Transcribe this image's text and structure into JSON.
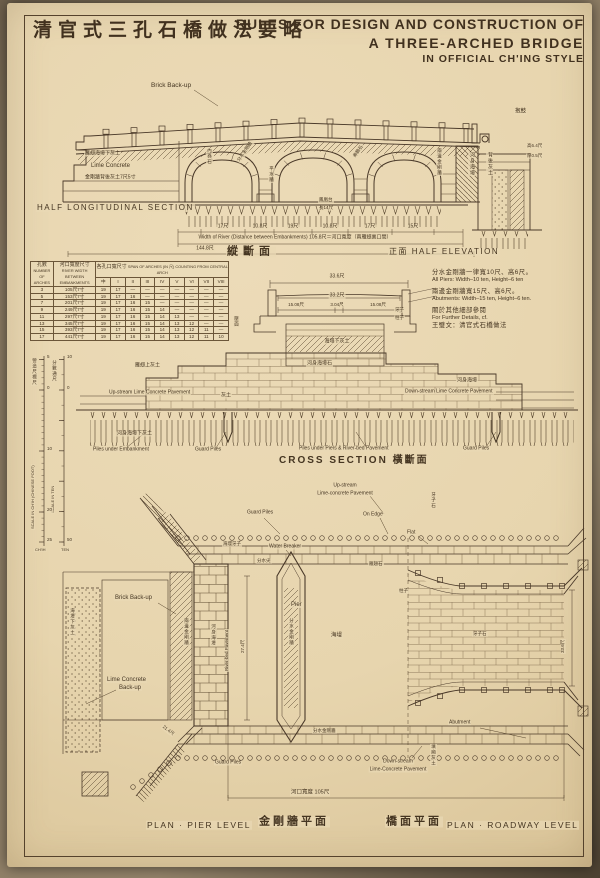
{
  "title": {
    "zh": "清官式三孔石橋做法要略",
    "en1": "RULES FOR DESIGN AND CONSTRUCTION OF",
    "en2": "A THREE-ARCHED BRIDGE",
    "en3": "IN OFFICIAL CH'ING STYLE"
  },
  "colors": {
    "paper": "#e8d6b0",
    "ink": "#4a3929",
    "faint_ink": "#7a6448"
  },
  "notes": {
    "lines": [
      {
        "t": "分水金剛牆一律寬10尺、高6尺。",
        "zh": true
      },
      {
        "t": "All Piers: Width–10 ten, Height–6 ten",
        "zh": false
      },
      {
        "t": "兩邊金剛牆寬15尺、高6尺。",
        "zh": true,
        "gap": true
      },
      {
        "t": "Abutments: Width–15 ten, Height–6 ten.",
        "zh": false
      },
      {
        "t": "關於其他細部參閱",
        "zh": true,
        "gap": true
      },
      {
        "t": "For Further Details, cf.",
        "zh": false
      },
      {
        "t": "王璧文：清官式石橋做法",
        "zh": true
      }
    ]
  },
  "table": {
    "h_arches_zh": "孔數",
    "h_arches_en": "NUMBER OF ARCHES",
    "h_width_zh": "河口寬度尺寸",
    "h_width_en": "RIVER WIDTH BETWEEN EMBANKMENTS",
    "h_span_zh": "各孔口寬尺寸",
    "h_span_en": "SPAN OF ARCHES (IN 尺) COUNTING FROM CENTRAL ARCH",
    "span_cols": [
      "中",
      "I",
      "II",
      "III",
      "IV",
      "V",
      "VI",
      "VII",
      "VIII"
    ],
    "rows": [
      {
        "arches": "3",
        "river_width": "105尺7寸",
        "spans": [
          "19",
          "17",
          "—",
          "—",
          "—",
          "—",
          "—",
          "—",
          "—"
        ]
      },
      {
        "arches": "5",
        "river_width": "153尺7寸",
        "spans": [
          "19",
          "17",
          "16",
          "—",
          "—",
          "—",
          "—",
          "—",
          "—"
        ]
      },
      {
        "arches": "7",
        "river_width": "201尺7寸",
        "spans": [
          "19",
          "17",
          "16",
          "15",
          "—",
          "—",
          "—",
          "—",
          "—"
        ]
      },
      {
        "arches": "9",
        "river_width": "249尺7寸",
        "spans": [
          "19",
          "17",
          "16",
          "15",
          "14",
          "—",
          "—",
          "—",
          "—"
        ]
      },
      {
        "arches": "11",
        "river_width": "297尺7寸",
        "spans": [
          "19",
          "17",
          "16",
          "15",
          "14",
          "13",
          "—",
          "—",
          "—"
        ]
      },
      {
        "arches": "13",
        "river_width": "345尺7寸",
        "spans": [
          "19",
          "17",
          "16",
          "15",
          "14",
          "13",
          "12",
          "—",
          "—"
        ]
      },
      {
        "arches": "15",
        "river_width": "393尺7寸",
        "spans": [
          "19",
          "17",
          "16",
          "15",
          "14",
          "13",
          "12",
          "11",
          "—"
        ]
      },
      {
        "arches": "17",
        "river_width": "441尺7寸",
        "spans": [
          "19",
          "17",
          "16",
          "15",
          "14",
          "13",
          "12",
          "11",
          "10"
        ]
      }
    ]
  },
  "annotations": [
    {
      "n": "label-brick-backup-section",
      "t": "Brick Back-up",
      "x": 150,
      "y": 86,
      "s": 6.5
    },
    {
      "n": "caption-half-longitudinal-section",
      "t": "HALF LONGITUDINAL SECTION",
      "x": 36,
      "y": 208,
      "s": 8,
      "ls": 1.5
    },
    {
      "n": "caption-longitudinal-zh",
      "t": "縱斷面",
      "x": 226,
      "y": 252,
      "s": 11,
      "b": 1,
      "ls": 5
    },
    {
      "n": "caption-half-elevation",
      "t": "正面  HALF ELEVATION",
      "x": 388,
      "y": 252,
      "s": 8,
      "ls": 1.5
    },
    {
      "n": "label-lime-concrete-section",
      "t": "Lime Concrete",
      "x": 90,
      "y": 166,
      "s": 6
    },
    {
      "n": "label-lime-backing-zh",
      "t": "金剛牆背後灰土7尺5寸",
      "x": 84,
      "y": 178,
      "s": 5
    },
    {
      "n": "label-wing-pavement-zh",
      "t": "雁翅海墁下灰土",
      "x": 84,
      "y": 154,
      "s": 5
    },
    {
      "n": "label-baogu",
      "t": "抱鼓",
      "x": 514,
      "y": 112,
      "s": 5.5
    },
    {
      "n": "label-riverbed-pav-v1",
      "t": "河身海墁",
      "x": 468,
      "y": 152,
      "v": 1,
      "s": 5
    },
    {
      "n": "label-backfill-v1",
      "t": "背後灰土",
      "x": 486,
      "y": 152,
      "v": 1,
      "s": 5
    },
    {
      "n": "label-height-dim",
      "t": "高6.4尺",
      "x": 526,
      "y": 146,
      "s": 4.5
    },
    {
      "n": "label-thick-dim",
      "t": "厚0.5尺",
      "x": 526,
      "y": 156,
      "s": 4.5
    },
    {
      "n": "label-arch-ring-v",
      "t": "內券石",
      "x": 206,
      "y": 148,
      "v": 1,
      "s": 4.5
    },
    {
      "n": "label-pier-wall-diag",
      "t": "分水金剛牆",
      "x": 238,
      "y": 162,
      "r": -55,
      "s": 4.5
    },
    {
      "n": "label-archface-diag",
      "t": "券臉石",
      "x": 354,
      "y": 158,
      "r": -55,
      "s": 4.5
    },
    {
      "n": "label-side-wall-v1",
      "t": "兩邊金剛牆",
      "x": 436,
      "y": 148,
      "v": 1,
      "s": 4.5
    },
    {
      "n": "label-pingshui-v",
      "t": "平水牆",
      "x": 268,
      "y": 166,
      "v": 1,
      "s": 4.5
    },
    {
      "n": "label-fenghuangtai",
      "t": "鳳凰台",
      "x": 318,
      "y": 200,
      "s": 4.5
    },
    {
      "n": "label-length-dim",
      "t": "長14尺",
      "x": 318,
      "y": 208,
      "s": 4.5
    },
    {
      "n": "dim-17a",
      "t": "17尺",
      "x": 223,
      "y": 227,
      "a": "c",
      "s": 5
    },
    {
      "n": "dim-108a",
      "t": "10.8尺",
      "x": 260,
      "y": 227,
      "a": "c",
      "s": 5
    },
    {
      "n": "dim-19",
      "t": "19尺",
      "x": 293,
      "y": 227,
      "a": "c",
      "s": 5
    },
    {
      "n": "dim-108b",
      "t": "10.8尺",
      "x": 330,
      "y": 227,
      "a": "c",
      "s": 5
    },
    {
      "n": "dim-17b",
      "t": "17尺",
      "x": 370,
      "y": 227,
      "a": "c",
      "s": 5
    },
    {
      "n": "dim-15",
      "t": "15尺",
      "x": 413,
      "y": 227,
      "a": "c",
      "s": 5
    },
    {
      "n": "dim-river-width",
      "t": "Width of River (Distance between Embankments) 105.8尺＝河口寬度（兩雁翅裏口間）",
      "x": 295,
      "y": 238,
      "a": "c",
      "s": 5
    },
    {
      "n": "dim-total-width",
      "t": "144.8尺",
      "x": 205,
      "y": 249,
      "a": "c",
      "s": 5
    },
    {
      "n": "dim-336-top",
      "t": "33.6尺",
      "x": 337,
      "y": 277,
      "a": "c",
      "s": 5
    },
    {
      "n": "dim-332",
      "t": "33.2尺",
      "x": 337,
      "y": 296,
      "a": "c",
      "s": 5
    },
    {
      "n": "dim-1508a",
      "t": "15.08尺",
      "x": 296,
      "y": 305,
      "a": "c",
      "s": 4.5
    },
    {
      "n": "dim-304",
      "t": "3.04尺",
      "x": 337,
      "y": 305,
      "a": "c",
      "s": 4.5
    },
    {
      "n": "dim-1508b",
      "t": "15.08尺",
      "x": 378,
      "y": 305,
      "a": "c",
      "s": 4.5
    },
    {
      "n": "label-deck-lime",
      "t": "海墁下灰土",
      "x": 337,
      "y": 342,
      "a": "c",
      "s": 5
    },
    {
      "n": "label-yazi-sec",
      "t": "牙子",
      "x": 394,
      "y": 310,
      "s": 4.5
    },
    {
      "n": "label-zhuzi-sec",
      "t": "柱子",
      "x": 394,
      "y": 318,
      "s": 4.5
    },
    {
      "n": "label-yamian-v",
      "t": "壓面",
      "x": 233,
      "y": 316,
      "v": 1,
      "s": 4.5
    },
    {
      "n": "label-riverbed-stone",
      "t": "河身海墁石",
      "x": 306,
      "y": 364,
      "s": 5
    },
    {
      "n": "label-wing-lime",
      "t": "雁翅上灰土",
      "x": 134,
      "y": 366,
      "s": 5
    },
    {
      "n": "label-upstream-pavement-cs",
      "t": "Up-stream Lime Concrete Pavement",
      "x": 108,
      "y": 393,
      "s": 5
    },
    {
      "n": "label-huitu",
      "t": "灰土",
      "x": 220,
      "y": 396,
      "s": 5
    },
    {
      "n": "label-riverbed-pav2",
      "t": "河身海墁",
      "x": 456,
      "y": 381,
      "s": 5
    },
    {
      "n": "label-downstream-pavement-cs",
      "t": "Down-stream Lime Concrete Pavement",
      "x": 404,
      "y": 392,
      "s": 5
    },
    {
      "n": "label-riverbed-lime",
      "t": "河身海墁下灰土",
      "x": 116,
      "y": 434,
      "s": 5
    },
    {
      "n": "label-piles-embankment",
      "t": "Piles under Embankment",
      "x": 92,
      "y": 450,
      "s": 5
    },
    {
      "n": "label-guard-piles-cross-left",
      "t": "Guard Piles",
      "x": 194,
      "y": 450,
      "s": 5
    },
    {
      "n": "label-piles-piers",
      "t": "Piles under Piers & River-bed Pavement",
      "x": 298,
      "y": 449,
      "s": 5
    },
    {
      "n": "label-guard-piles-cross-right",
      "t": "Guard Piles",
      "x": 462,
      "y": 449,
      "s": 5
    },
    {
      "n": "caption-cross-section",
      "t": "CROSS SECTION  橫斷面",
      "x": 278,
      "y": 461,
      "s": 10,
      "ls": 2,
      "b": 1
    },
    {
      "n": "ruler-zh-left",
      "t": "營造尺標尺",
      "x": 31,
      "y": 358,
      "v": 1,
      "s": 4.5
    },
    {
      "n": "ruler-zh-right",
      "t": "分數通尺",
      "x": 51,
      "y": 360,
      "v": 1,
      "s": 4.5
    },
    {
      "n": "ruler-en-left",
      "t": "SCALE IN CH'IH (CHINESE FOOT)",
      "x": 33,
      "y": 530,
      "r": -90,
      "s": 4
    },
    {
      "n": "ruler-en-right",
      "t": "SCALE IN TEN",
      "x": 53,
      "y": 514,
      "r": -90,
      "s": 4
    },
    {
      "n": "tick-l5",
      "t": "5",
      "x": 46,
      "y": 357,
      "s": 4.5
    },
    {
      "n": "tick-l0",
      "t": "0",
      "x": 46,
      "y": 388,
      "s": 4.5
    },
    {
      "n": "tick-l10",
      "t": "10",
      "x": 46,
      "y": 449,
      "s": 4.5
    },
    {
      "n": "tick-l20",
      "t": "20",
      "x": 46,
      "y": 510,
      "s": 4.5
    },
    {
      "n": "tick-l25",
      "t": "25",
      "x": 46,
      "y": 540,
      "s": 4.5
    },
    {
      "n": "tick-lunit",
      "t": "CH'IH",
      "x": 34,
      "y": 550,
      "s": 4
    },
    {
      "n": "tick-r10t",
      "t": "10",
      "x": 66,
      "y": 357,
      "s": 4.5
    },
    {
      "n": "tick-r0",
      "t": "0",
      "x": 66,
      "y": 388,
      "s": 4.5
    },
    {
      "n": "tick-r50",
      "t": "50",
      "x": 66,
      "y": 540,
      "s": 4.5
    },
    {
      "n": "tick-runit",
      "t": "TEN",
      "x": 60,
      "y": 550,
      "s": 4
    },
    {
      "n": "label-guard-piles-plan-top",
      "t": "Guard Piles",
      "x": 246,
      "y": 513,
      "s": 5
    },
    {
      "n": "label-upstream-1",
      "t": "Up-stream",
      "x": 345,
      "y": 486,
      "a": "c",
      "s": 5
    },
    {
      "n": "label-upstream-2",
      "t": "Lime-concrete Pavement",
      "x": 345,
      "y": 494,
      "a": "c",
      "s": 5
    },
    {
      "n": "label-on-edge",
      "t": "On Edge",
      "x": 362,
      "y": 515,
      "s": 5
    },
    {
      "n": "label-flat",
      "t": "Flat",
      "x": 406,
      "y": 533,
      "s": 5
    },
    {
      "n": "label-water-breaker",
      "t": "Water Breaker",
      "x": 268,
      "y": 547,
      "s": 5
    },
    {
      "n": "label-haiman-yazi",
      "t": "海墁牙子",
      "x": 222,
      "y": 544,
      "s": 4.5
    },
    {
      "n": "label-yazishi-v-top",
      "t": "牙子石",
      "x": 430,
      "y": 492,
      "v": 1,
      "s": 4.5
    },
    {
      "n": "label-yanchishi",
      "t": "雁翅石",
      "x": 368,
      "y": 564,
      "s": 4.5
    },
    {
      "n": "label-zhuzi-plan",
      "t": "柱子",
      "x": 398,
      "y": 591,
      "s": 4.5
    },
    {
      "n": "label-fenshuijian",
      "t": "分水尖",
      "x": 256,
      "y": 561,
      "s": 4.5
    },
    {
      "n": "label-brick-backup-plan",
      "t": "Brick Back-up",
      "x": 114,
      "y": 598,
      "s": 6
    },
    {
      "n": "label-lime-backup-1",
      "t": "Lime Concrete",
      "x": 106,
      "y": 680,
      "s": 6
    },
    {
      "n": "label-lime-backup-2",
      "t": "Back-up",
      "x": 118,
      "y": 688,
      "s": 6
    },
    {
      "n": "label-pier",
      "t": "Pier",
      "x": 290,
      "y": 605,
      "s": 6
    },
    {
      "n": "dim-274",
      "t": "27.4尺",
      "x": 243,
      "y": 654,
      "r": -90,
      "s": 4.5
    },
    {
      "n": "label-side-wall-v2",
      "t": "兩邊金剛牆",
      "x": 183,
      "y": 618,
      "v": 1,
      "s": 4.5
    },
    {
      "n": "label-riverbed-v2",
      "t": "河身海墁",
      "x": 210,
      "y": 624,
      "v": 1,
      "s": 4.5
    },
    {
      "n": "label-riverbed-en-v",
      "t": "River-bed Pavement",
      "x": 227,
      "y": 672,
      "r": -90,
      "s": 4.5
    },
    {
      "n": "label-pier-wall-v2",
      "t": "分水金剛牆",
      "x": 288,
      "y": 618,
      "v": 1,
      "s": 4.5
    },
    {
      "n": "label-lime-under-v",
      "t": "海墁下灰土",
      "x": 69,
      "y": 608,
      "v": 1,
      "s": 4.5
    },
    {
      "n": "label-haiman-plan",
      "t": "海墁",
      "x": 330,
      "y": 636,
      "s": 5.5
    },
    {
      "n": "label-yazishi2",
      "t": "牙子石",
      "x": 472,
      "y": 634,
      "s": 4.5
    },
    {
      "n": "dim-336-v",
      "t": "33.6尺",
      "x": 563,
      "y": 654,
      "r": -90,
      "s": 4.5
    },
    {
      "n": "label-pier-wall3",
      "t": "分水金剛牆",
      "x": 312,
      "y": 731,
      "s": 4.5
    },
    {
      "n": "label-abutment",
      "t": "Abutment",
      "x": 448,
      "y": 723,
      "s": 5
    },
    {
      "n": "dim-214",
      "t": "21.4尺",
      "x": 162,
      "y": 726,
      "r": 38,
      "s": 4.5
    },
    {
      "n": "label-guard-piles-plan-bottom",
      "t": "Guard Piles",
      "x": 214,
      "y": 763,
      "s": 5
    },
    {
      "n": "label-downstream-1",
      "t": "Down-stream",
      "x": 398,
      "y": 762,
      "a": "c",
      "s": 5
    },
    {
      "n": "label-downstream-2",
      "t": "Lime-Concrete Pavement",
      "x": 398,
      "y": 770,
      "a": "c",
      "s": 5
    },
    {
      "n": "label-tianxiang-v",
      "t": "填廂灰土",
      "x": 430,
      "y": 744,
      "v": 1,
      "s": 4.5
    },
    {
      "n": "dim-hekou",
      "t": "河口寬度 105尺",
      "x": 290,
      "y": 793,
      "s": 5.5
    },
    {
      "n": "caption-plan-pier-en",
      "t": "PLAN · PIER LEVEL",
      "x": 146,
      "y": 825,
      "s": 8.5,
      "ls": 1.5
    },
    {
      "n": "caption-plan-pier-zh",
      "t": "金剛牆平面",
      "x": 258,
      "y": 822,
      "s": 11,
      "b": 1,
      "ls": 3
    },
    {
      "n": "caption-plan-road-zh",
      "t": "橋面平面",
      "x": 385,
      "y": 822,
      "s": 11,
      "b": 1,
      "ls": 3
    },
    {
      "n": "caption-plan-road-en",
      "t": "PLAN · ROADWAY LEVEL",
      "x": 446,
      "y": 825,
      "s": 8.5,
      "ls": 1.5
    }
  ]
}
